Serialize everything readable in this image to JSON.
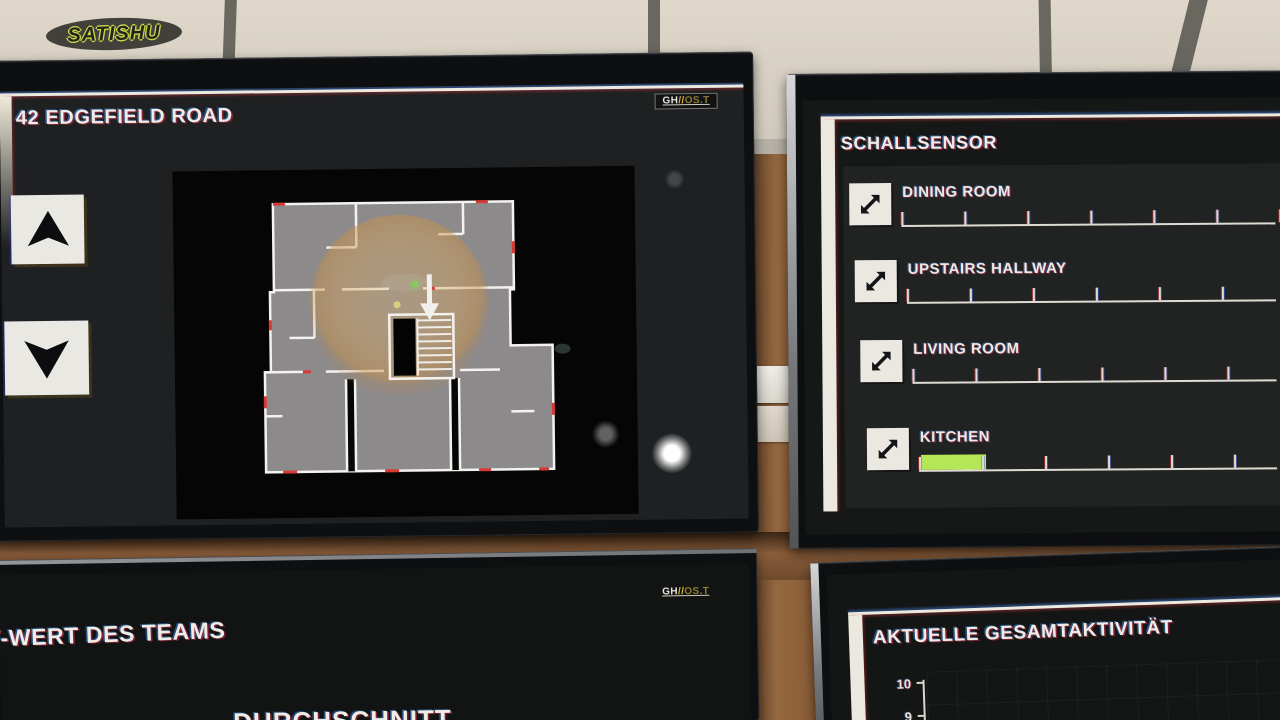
{
  "watermark": {
    "text": "SATISHU"
  },
  "map_monitor": {
    "brand": {
      "gh": "GH",
      "sep": "//",
      "os": "OS.T"
    },
    "title": "42 EDGEFIELD ROAD",
    "icons": {
      "up": "up-arrow",
      "down": "down-arrow",
      "map_marker": "down-arrow-marker"
    },
    "map": {
      "sensor_radius_color": "#d6a35a",
      "entity_dot_color": "#86c95e",
      "secondary_dot_color": "#e4d17e"
    }
  },
  "sound_monitor": {
    "title": "SCHALLSENSOR",
    "row_icon": "diagonal-expand-arrow",
    "rows": [
      {
        "label": "DINING ROOM",
        "level_fraction": 0
      },
      {
        "label": "UPSTAIRS HALLWAY",
        "level_fraction": 0
      },
      {
        "label": "LIVING ROOM",
        "level_fraction": 0
      },
      {
        "label": "KITCHEN",
        "level_fraction": 0.17,
        "bar_color": "#b5e658"
      }
    ]
  },
  "team_monitor": {
    "brand": {
      "gh": "GH",
      "sep": "//",
      "os": "OS.T"
    },
    "title": "Y-WERT DES TEAMS",
    "subtitle": "DURCHSCHNITT"
  },
  "activity_monitor": {
    "title": "AKTUELLE GESAMTAKTIVITÄT",
    "chart_data": {
      "type": "line",
      "title": "AKTUELLE GESAMTAKTIVITÄT",
      "y_ticks_visible": [
        "10",
        "9"
      ],
      "ylim": [
        9,
        10
      ],
      "grid": true,
      "series": []
    }
  }
}
